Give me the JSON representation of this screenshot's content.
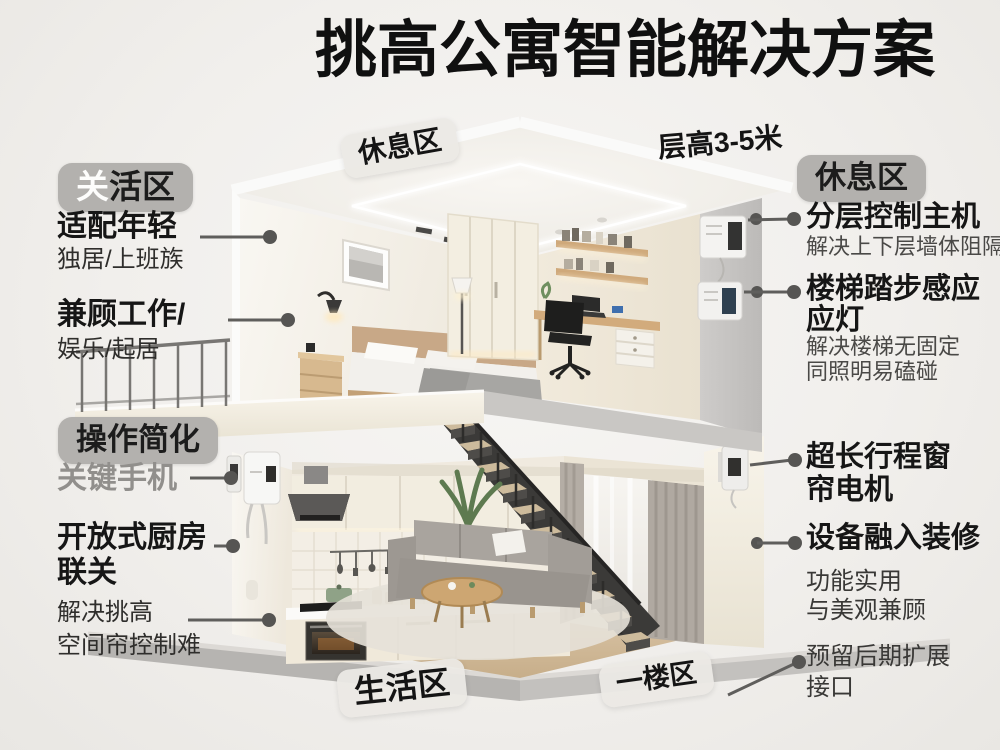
{
  "title": "挑高公寓智能解决方案",
  "scene_tags": {
    "upper_zone": "休息区",
    "ceiling_height": "层高3-5米",
    "lower_zone": "生活区",
    "first_floor": "一楼区"
  },
  "left": {
    "zone_badge": {
      "first": "关",
      "rest": "活区"
    },
    "ops_badge": "操作简化",
    "item1": {
      "title": "适配年轻",
      "sub": "独居/上班族"
    },
    "item2": {
      "title": "兼顾工作/",
      "sub": "娱乐/起居"
    },
    "item3": {
      "title": "关键手机"
    },
    "item4": {
      "title": "开放式厨房",
      "title2": "联关"
    },
    "item5": {
      "sub": "解决挑高",
      "sub2": "空间帘控制难"
    }
  },
  "right": {
    "zone_badge": "休息区",
    "item1": {
      "title": "分层控制主机",
      "sub": "解决上下层墙体阻隔"
    },
    "item2": {
      "title": "楼梯踏步感应",
      "title2": "应灯",
      "sub": "解决楼梯无固定",
      "sub2": "同照明易磕碰"
    },
    "item3": {
      "title": "超长行程窗",
      "title2": "帘电机"
    },
    "item4": {
      "title": "设备融入装修",
      "sub": "功能实用",
      "sub2": "与美观兼顾"
    },
    "item5": {
      "sub": "预留后期扩展",
      "sub2": "接口"
    }
  },
  "colors": {
    "background": "#f1efec",
    "badge_gray": "#b3b1ae",
    "text_dark": "#161616",
    "text_muted": "#918f8c",
    "connector": "#5f5e5c",
    "wood_accent": "#c89f6e",
    "wall_cream": "#f0eadf",
    "wall_gray": "#c6c4c2"
  }
}
